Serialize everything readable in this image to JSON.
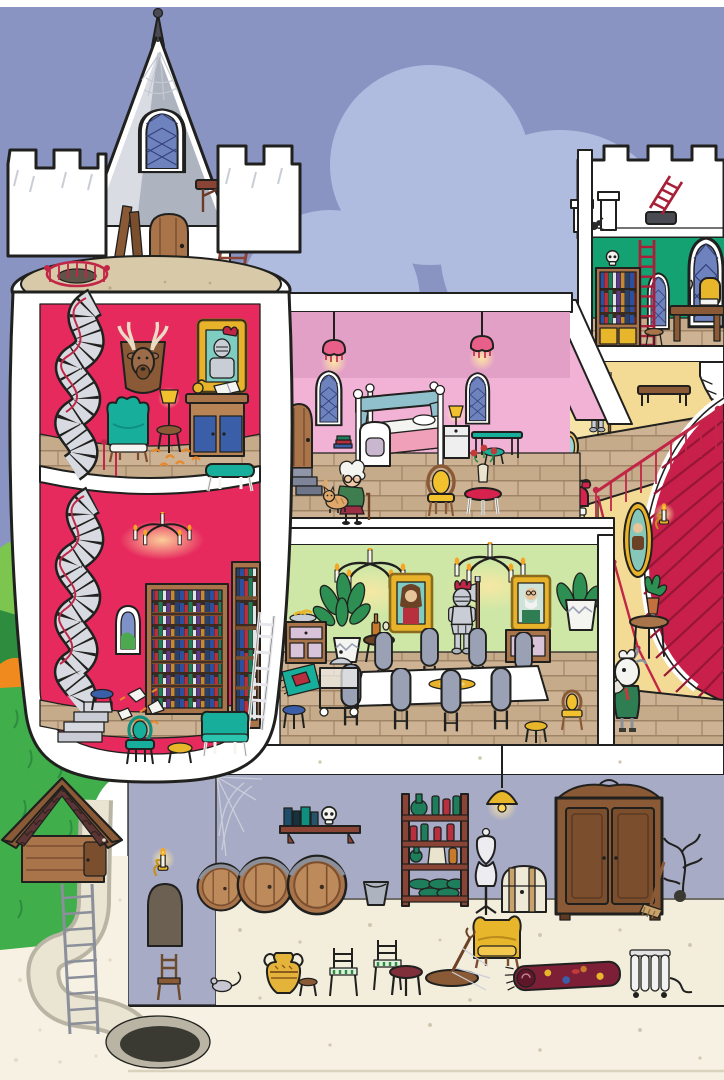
{
  "scene": {
    "type": "cutaway-castle-illustration",
    "palette": {
      "sky": "#8A94C3",
      "cloud": "#AFBBDF",
      "tower_wall": "#E62A5E",
      "terrace": "#D8C9A9",
      "roof_light": "#D9DCE3",
      "roof_dark": "#AEB4BF",
      "bedroom_wall_upper": "#E2A0C6",
      "bedroom_wall": "#F2B2D6",
      "dining_wall": "#CFE7A6",
      "hall_wall": "#F3DB96",
      "hall_wall_near": "#F6E3A8",
      "attic_wall": "#14A273",
      "basement_wall": "#A8ABC5",
      "basement_floor": "#F3EEDC",
      "ground": "#F6F1E2",
      "carpet": "#C81F4B",
      "grass": "#3FAE4B",
      "plank": "#CDB394",
      "wood": "#A9744A",
      "teal": "#17AF9B",
      "gold": "#E8B32A",
      "metal": "#C9CDD6",
      "glow": "#FFE9A3"
    },
    "outdoor": {
      "items": [
        "sky",
        "cumulus-clouds",
        "hedge-bushes",
        "orange-bush",
        "grass-bank",
        "sand-path",
        "garden-shed",
        "shaft-ladder",
        "underground-tunnel",
        "tunnel-hole"
      ]
    },
    "tower": {
      "rooftop": [
        "conical-turret",
        "spire",
        "spiderweb",
        "arched-window",
        "wooden-door",
        "leaning-planks",
        "ladder",
        "wooden-platform",
        "spiral-stair-exit-railing",
        "battlements"
      ],
      "trophy_room": [
        "spiral-staircase",
        "deer-head-trophy",
        "knight-portrait",
        "wingback-armchair",
        "table-lamp",
        "side-stool",
        "writing-desk",
        "open-book",
        "footstool",
        "scattered-leaves"
      ],
      "library": [
        "spiral-staircase",
        "candle-chandelier",
        "arrow-slit-window",
        "tall-bookcase",
        "second-bookcase",
        "leaning-ladder",
        "torn-papers",
        "armchair",
        "settee",
        "yellow-stool",
        "blue-stool"
      ]
    },
    "bedroom": {
      "items": [
        "pendant-lamps",
        "arched-windows",
        "four-poster-bed",
        "nightstand-with-lamp",
        "console-table",
        "teal-stool",
        "oval-back-chair",
        "flower-table",
        "book-stack",
        "tower-door",
        "steps",
        "grandma-with-cane",
        "cat"
      ]
    },
    "dining_hall": {
      "items": [
        "candle-chandeliers",
        "lady-portrait",
        "gentleman-portrait",
        "knight-armor-statue",
        "potted-plant-left",
        "potted-plant-right",
        "sideboard-left",
        "sideboard-right",
        "fruit-bowl",
        "wine-table",
        "serving-cart-with-cloche",
        "long-dining-table",
        "gold-platter",
        "high-back-chairs",
        "rug",
        "blue-stool",
        "yellow-stool",
        "side-chair"
      ]
    },
    "stair_hall": {
      "items": [
        "crossed-axes",
        "torch-sconce",
        "knight-armor-statue",
        "wall-bench",
        "balcony-railing",
        "grand-red-staircase",
        "upper-stair-fragment",
        "oval-portrait",
        "candle-sconce",
        "hall-door",
        "oval-mirror",
        "red-telephone-on-stool",
        "goat-butler",
        "plant-side-table"
      ]
    },
    "attic": {
      "items": [
        "battlement-parapet",
        "roof-spider",
        "chimneys",
        "red-ladder",
        "roof-hatch",
        "bookcase-with-skull",
        "stool",
        "gothic-window-small",
        "gothic-window-large",
        "writing-desk",
        "quill-and-book",
        "gold-chair"
      ]
    },
    "basement": {
      "items": [
        "cobweb",
        "wall-shelf-with-skull",
        "wine-barrels",
        "bucket",
        "bottle-rack",
        "hanging-lamp",
        "tailor-mannequin",
        "treasure-chest",
        "wardrobe",
        "broom",
        "dry-branch",
        "candle-sconce",
        "arched-doorway",
        "wooden-chair",
        "mouse",
        "amphora",
        "small-stool",
        "striped-chairs",
        "round-table",
        "fallen-coat-rack",
        "yellow-armchair",
        "rolled-carpet",
        "radiator"
      ]
    }
  }
}
